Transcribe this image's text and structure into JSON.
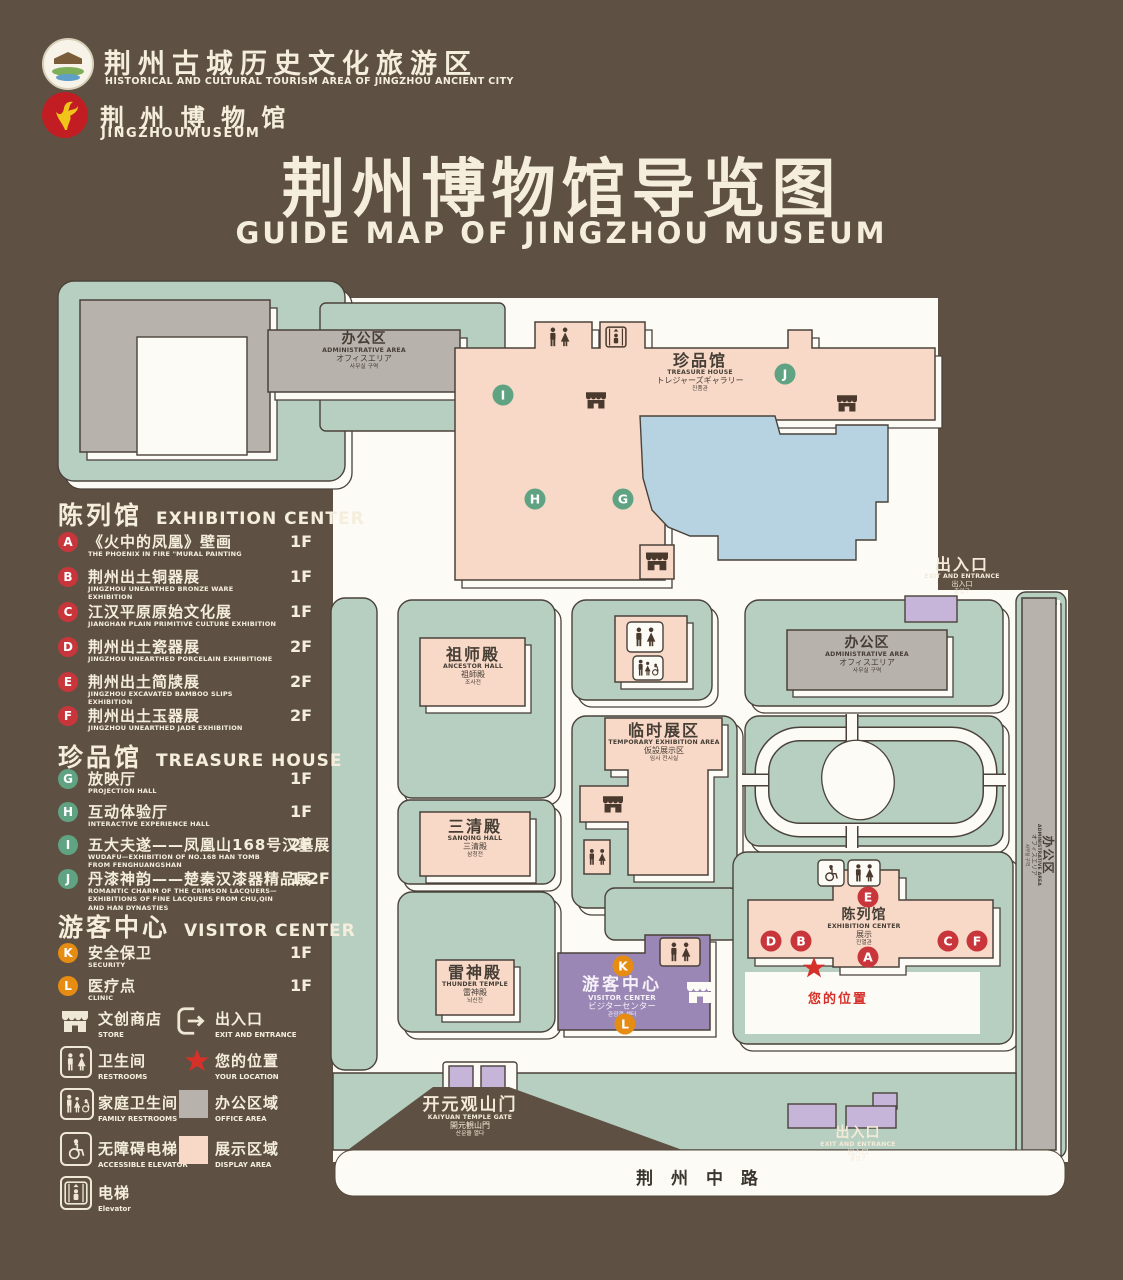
{
  "header": {
    "org_name": "荆州古城历史文化旅游区",
    "org_sub": "HISTORICAL AND CULTURAL TOURISM AREA OF JINGZHOU ANCIENT CITY",
    "museum_name": "荆 州 博 物 馆",
    "museum_sub": "JINGZHOUMUSEUM",
    "title": "荆州博物馆导览图",
    "subtitle": "GUIDE MAP OF JINGZHOU MUSEUM"
  },
  "legend": {
    "sections": [
      {
        "zh": "陈列馆",
        "en": "EXHIBITION CENTER",
        "items": [
          {
            "letter": "A",
            "zh": "《火中的凤凰》壁画",
            "en": "THE PHOENIX IN FIRE \"MURAL PAINTING",
            "floor": "1F"
          },
          {
            "letter": "B",
            "zh": "荆州出土铜器展",
            "en": "JINGZHOU UNEARTHED BRONZE WARE EXHIBITION",
            "floor": "1F"
          },
          {
            "letter": "C",
            "zh": "江汉平原原始文化展",
            "en": "JIANGHAN PLAIN PRIMITIVE CULTURE EXHIBITION",
            "floor": "1F"
          },
          {
            "letter": "D",
            "zh": "荆州出土瓷器展",
            "en": "JINGZHOU UNEARTHED PORCELAIN EXHIBITIONE",
            "floor": "2F"
          },
          {
            "letter": "E",
            "zh": "荆州出土简牍展",
            "en": "JINGZHOU EXCAVATED BAMBOO SLIPS EXHIBITION",
            "floor": "2F"
          },
          {
            "letter": "F",
            "zh": "荆州出土玉器展",
            "en": "JINGZHOU UNEARTHED JADE EXHIBITION",
            "floor": "2F"
          }
        ]
      },
      {
        "zh": "珍品馆",
        "en": "TREASURE HOUSE",
        "items": [
          {
            "letter": "G",
            "zh": "放映厅",
            "en": "PROJECTION HALL",
            "floor": "1F"
          },
          {
            "letter": "H",
            "zh": "互动体验厅",
            "en": "INTERACTIVE EXPERIENCE HALL",
            "floor": "1F"
          },
          {
            "letter": "I",
            "zh": "五大夫遂——凤凰山168号汉墓展",
            "en": "WUDAFU—EXHIBITION OF NO.168 HAN TOMB FROM FENGHUANGSHAN",
            "floor": "2F"
          },
          {
            "letter": "J",
            "zh": "丹漆神韵——楚秦汉漆器精品展",
            "en": "ROMANTIC CHARM OF THE CRIMSON LACQUERS—EXHIBITIONS OF FINE LACQUERS FROM CHU,QIN AND HAN DYNASTIES",
            "floor": "1-2F"
          }
        ]
      },
      {
        "zh": "游客中心",
        "en": "VISITOR CENTER",
        "items": [
          {
            "letter": "K",
            "zh": "安全保卫",
            "en": "SECURITY",
            "floor": "1F"
          },
          {
            "letter": "L",
            "zh": "医疗点",
            "en": "CLINIC",
            "floor": "1F"
          }
        ]
      }
    ],
    "icons": [
      {
        "zh": "文创商店",
        "en": "STORE"
      },
      {
        "zh": "出入口",
        "en": "EXIT AND ENTRANCE"
      },
      {
        "zh": "卫生间",
        "en": "RESTROOMS"
      },
      {
        "zh": "您的位置",
        "en": "YOUR LOCATION"
      },
      {
        "zh": "家庭卫生间",
        "en": "FAMILY RESTROOMS"
      },
      {
        "zh": "办公区域",
        "en": "OFFICE AREA"
      },
      {
        "zh": "无障碍电梯",
        "en": "ACCESSIBLE ELEVATOR"
      },
      {
        "zh": "展示区域",
        "en": "DISPLAY AREA"
      },
      {
        "zh": "电梯",
        "en": "Elevator"
      }
    ]
  },
  "map": {
    "buildings": {
      "admin": {
        "zh": "办公区",
        "en": "ADMINISTRATIVE AREA",
        "jp": "オフィスエリア",
        "kr": "사무실 구역"
      },
      "treasure": {
        "zh": "珍品馆",
        "en": "TREASURE HOUSE",
        "jp": "トレジャーズギャラリー",
        "kr": "진품관"
      },
      "ancestor": {
        "zh": "祖师殿",
        "en": "ANCESTOR HALL",
        "jp": "祖師殿",
        "kr": "조사전"
      },
      "temporary": {
        "zh": "临时展区",
        "en": "TEMPORARY EXHIBITION AREA",
        "jp": "仮設展示区",
        "kr": "임시 전시실"
      },
      "sanqing": {
        "zh": "三清殿",
        "en": "SANQING HALL",
        "jp": "三清殿",
        "kr": "삼청전"
      },
      "thunder": {
        "zh": "雷神殿",
        "en": "THUNDER TEMPLE",
        "jp": "雷神殿",
        "kr": "뇌신전"
      },
      "exhibition": {
        "zh": "陈列馆",
        "en": "EXHIBITION CENTER",
        "jp": "展示",
        "kr": "진열관"
      },
      "visitor": {
        "zh": "游客中心",
        "en": "VISITOR CENTER",
        "jp": "ビジターセンター",
        "kr": "관광객 센터"
      },
      "gate": {
        "zh": "开元观山门",
        "en": "KAIYUAN TEMPLE GATE",
        "jp": "開元観山門",
        "kr": "산문을 열다"
      },
      "exit": {
        "zh": "出入口",
        "en": "EXIT AND ENTRANCE",
        "jp": "出入口",
        "kr": "출입구"
      }
    },
    "markers": {
      "red": [
        "A",
        "B",
        "C",
        "D",
        "E",
        "F"
      ],
      "green": [
        "G",
        "H",
        "I",
        "J"
      ],
      "orange": [
        "K",
        "L"
      ]
    },
    "road": "荆 州 中 路",
    "your_location": "您的位置"
  }
}
